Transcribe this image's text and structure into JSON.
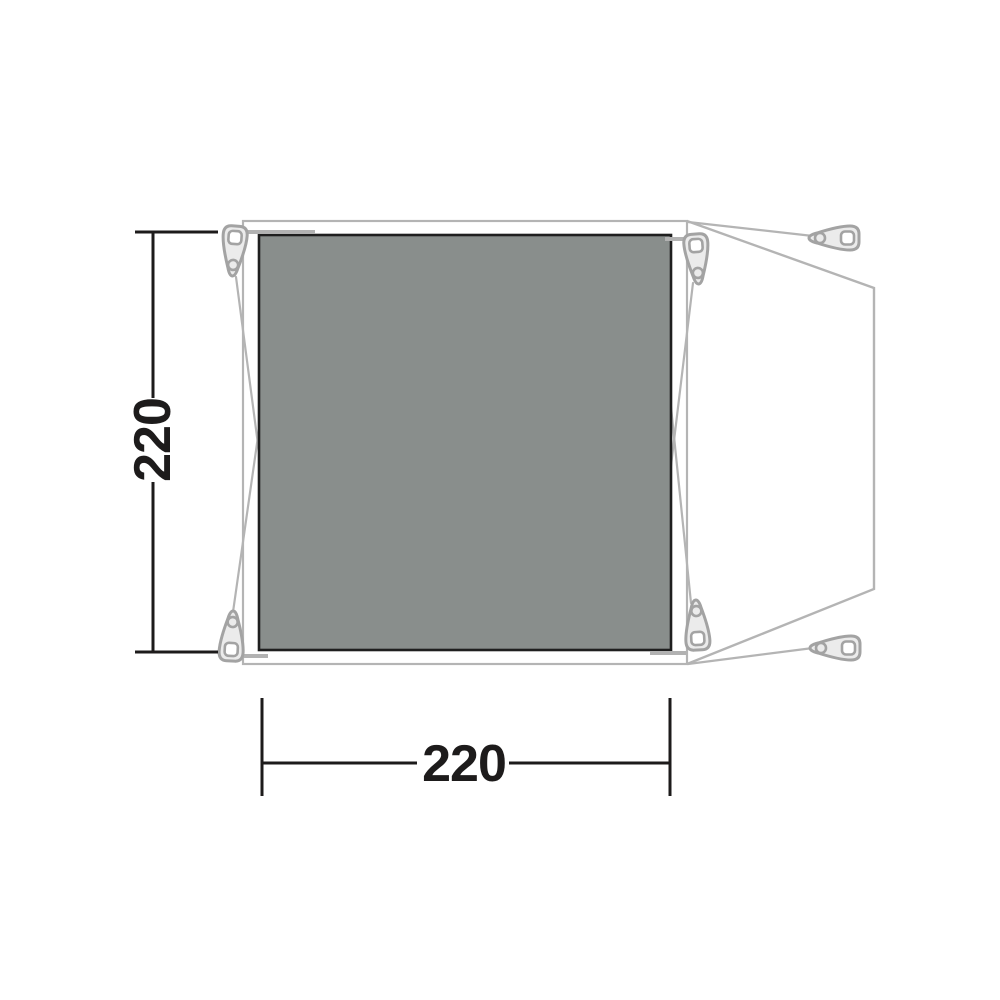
{
  "diagram": {
    "kind": "tent-footprint-dimension-plan",
    "dimensions": {
      "height": {
        "label": "220",
        "orientation": "vertical"
      },
      "width": {
        "label": "220",
        "orientation": "horizontal"
      }
    },
    "icons": {
      "peg": "tent-peg-icon",
      "peg_count": 6
    },
    "colors": {
      "background": "#ffffff",
      "groundsheet_fill": "#898e8c",
      "groundsheet_border": "#1f1f1f",
      "tent_outline": "#b4b4b4",
      "seam": "#b2b2b2",
      "peg_fill": "#ebebeb",
      "peg_stroke": "#a3a3a3",
      "dimension_line": "#1d1b1b"
    }
  }
}
